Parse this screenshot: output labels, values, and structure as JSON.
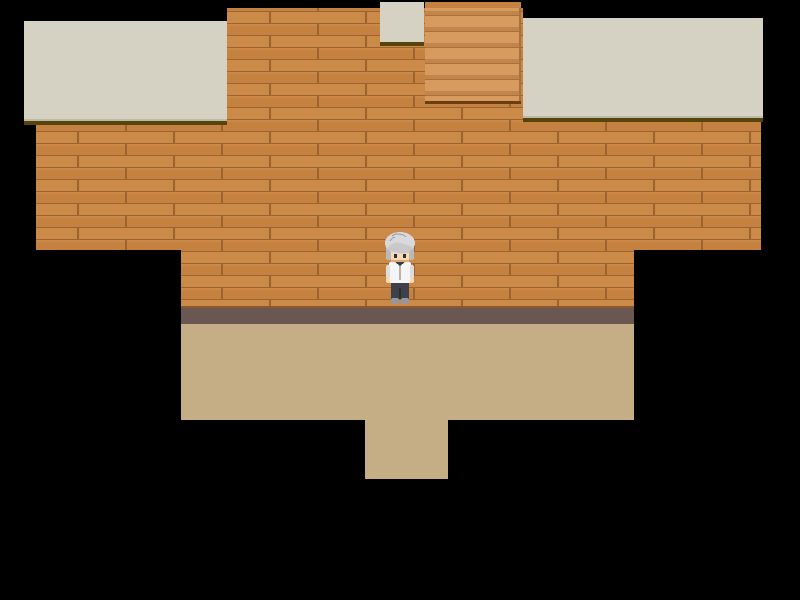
{
  "scene": {
    "name": "rpg-room-interior",
    "description": "Top-down RPG map screenshot: brown wood-plank wall spanning the room, two light ceiling panels with dark olive edges, a small light panel at top center, a light wooden staircase at top right of center, a mauve baseboard strip, a tan floor with a southern exit corridor, all surrounded by black void.",
    "character": {
      "name": "villager",
      "appearance": "gray-haired person, white shirt, dark gray pants, facing down",
      "facing": "down",
      "screen_position": {
        "x": 400,
        "y": 268
      }
    }
  },
  "colors": {
    "background": "#000000",
    "ceiling_panel": "#d5d1c3",
    "panel_shade": "#bdb9ab",
    "panel_edge_olive": "#55450a",
    "plank_base": "#c5813f",
    "plank_light": "#cc8a48",
    "plank_seam": "#9d6433",
    "plank_highlight": "#d0904e",
    "stair_light": "#d79a5f",
    "stair_mid": "#c4854b",
    "stair_line": "#a5713c",
    "stair_bottom_edge": "#6b3e14",
    "wall_shadow": "#8a5a2e",
    "baseboard": "#6b5751",
    "floor_tan": "#c5ae85",
    "hair_light": "#d9d9db",
    "hair_mid": "#b9b9bd",
    "hair_dark": "#8b8b90",
    "skin": "#ffd9ad",
    "skin_shadow": "#d8a97c",
    "eye": "#2e2e34",
    "shirt": "#f5f5f5",
    "shirt_shade": "#dcdcde",
    "collar_dark": "#3a3a42",
    "pants": "#3e404a",
    "pants_dark": "#2b2c34",
    "shoes": "#9496a0"
  }
}
